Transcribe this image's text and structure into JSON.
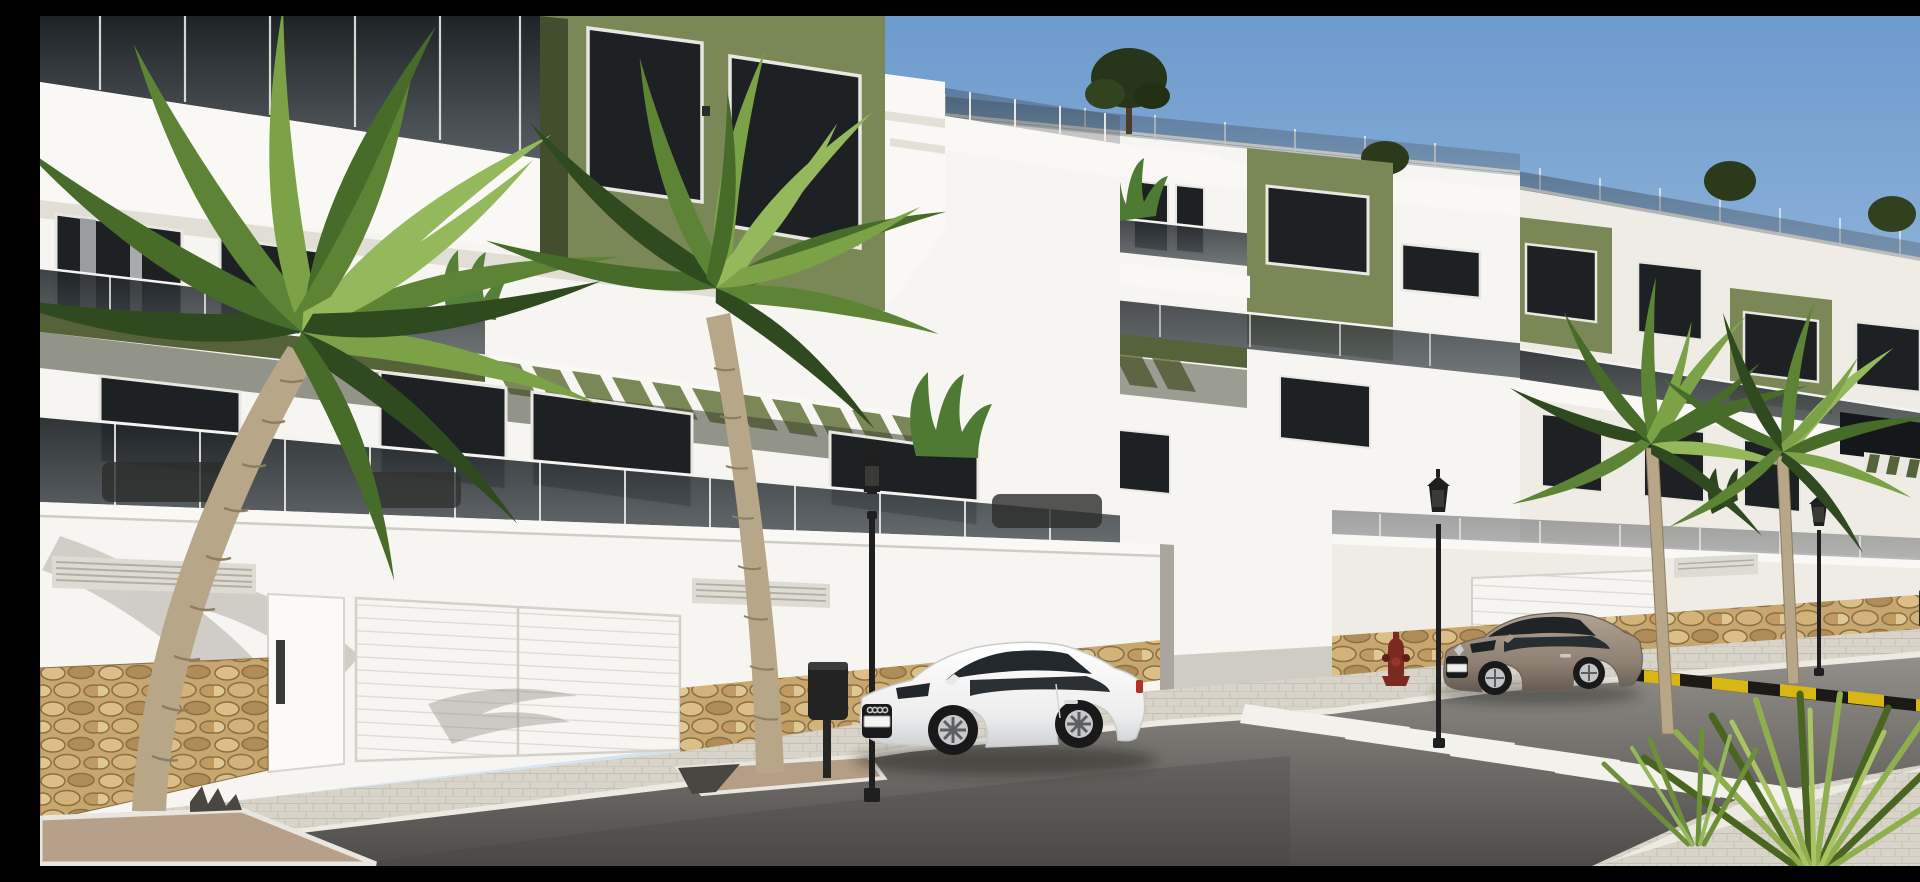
{
  "meta": {
    "title": "New-build apartment complex — exterior street render",
    "image_kind": "3D architectural visualization, daylight, clear sky"
  },
  "scene": {
    "description": "Daylight 3D render of a modern white apartment complex with olive-green accent volumes, smoked-glass balcony balustrades and green pergola slats. A white boundary/garage wall with a natural stone base runs along a paved sidewalk. A white Audi TT coupe is parked at the kerb in the centre and a bronze-grey Renault Megane coupe is parked on the right before a zebra crosswalk. Four tall palm trees, ornate black street lamps, litter bins, a red fire hydrant and a yellow-black painted kerb strip line the street; small yucca palms sit in the bottom-right corner.",
    "time_of_day": "midday",
    "weather": "clear",
    "no_visible_text": "license plates present but illegible"
  },
  "palette": {
    "sky_top": "#6d9bcd",
    "sky_mid": "#a3c2e0",
    "sky_bottom": "#e9f0f7",
    "hills": "#b9c9d8",
    "wall_white": "#efece6",
    "wall_white_lit": "#f7f5f1",
    "wall_shadow": "#d9d5cc",
    "slab_white": "#f9f8f5",
    "accent_green": "#7a8757",
    "accent_green_dark": "#55623a",
    "accent_green_shadow": "#434e2e",
    "window_glass": "#1d2124",
    "window_frame": "#e9e7e1",
    "balustrade_glass_top": "#1e2326",
    "balustrade_glass_bottom": "#5a6165",
    "rail_post": "#f4f3ef",
    "stone_base": "#c8a76e",
    "stone_light": "#dcbf88",
    "stone_dark": "#b08d58",
    "stone_joint": "#8a6f45",
    "sidewalk": "#d8d4c9",
    "kerb": "#eceae1",
    "road_far": "#93908b",
    "road_near": "#4e4c49",
    "crosswalk_stripe": "#f2f1ec",
    "warning_yellow": "#d8b614",
    "warning_black": "#1c1a16",
    "palm_trunk": "#b7a788",
    "palm_trunk_dark": "#8d7d61",
    "frond_greens": [
      "#2f4a1e",
      "#476b28",
      "#5d8434",
      "#7ba247",
      "#94b85c"
    ],
    "lamp_metal": "#1f1f1f",
    "hydrant_red": "#7a2a20",
    "car_white": "#f3f3f2",
    "car_bronze": "#96887a",
    "gravel": "#b7a089"
  },
  "inventory": {
    "building_blocks": [
      {
        "id": "block-a",
        "position": "left, nearest",
        "floors": 3,
        "features": [
          "smoked-glass balustrades",
          "olive accent box with two windows",
          "green fascia band",
          "pergola slats",
          "roof terrace railing"
        ]
      },
      {
        "id": "block-b",
        "position": "centre, middle distance",
        "floors": 3,
        "features": [
          "roof terrace with tree",
          "olive accent box",
          "balcony plants",
          "pergola slats"
        ]
      },
      {
        "id": "block-c",
        "position": "right, farthest",
        "floors": 3,
        "features": [
          "two olive accent boxes",
          "roof shrubs",
          "striped pergola edge",
          "tinted terrace glass"
        ]
      }
    ],
    "vehicles": [
      {
        "type": "coupe",
        "resembles": "Audi TT",
        "color": "white",
        "facing": "left",
        "location": "kerb, centre-left"
      },
      {
        "type": "coupe",
        "resembles": "Renault Megane",
        "color": "bronze-grey",
        "facing": "left",
        "location": "kerb, right, before crosswalk"
      }
    ],
    "palm_trees_tall": 4,
    "yucca_clusters_bottom_right": 2,
    "street_lamps": 4,
    "litter_bins": 2,
    "fire_hydrants": 1,
    "crosswalk_stripes": 5,
    "pedestrian_doors": 1,
    "garage_doors": 2,
    "wall_vent_grilles": 3,
    "tree_planters": 2,
    "pergola_slat_rows": 3
  }
}
